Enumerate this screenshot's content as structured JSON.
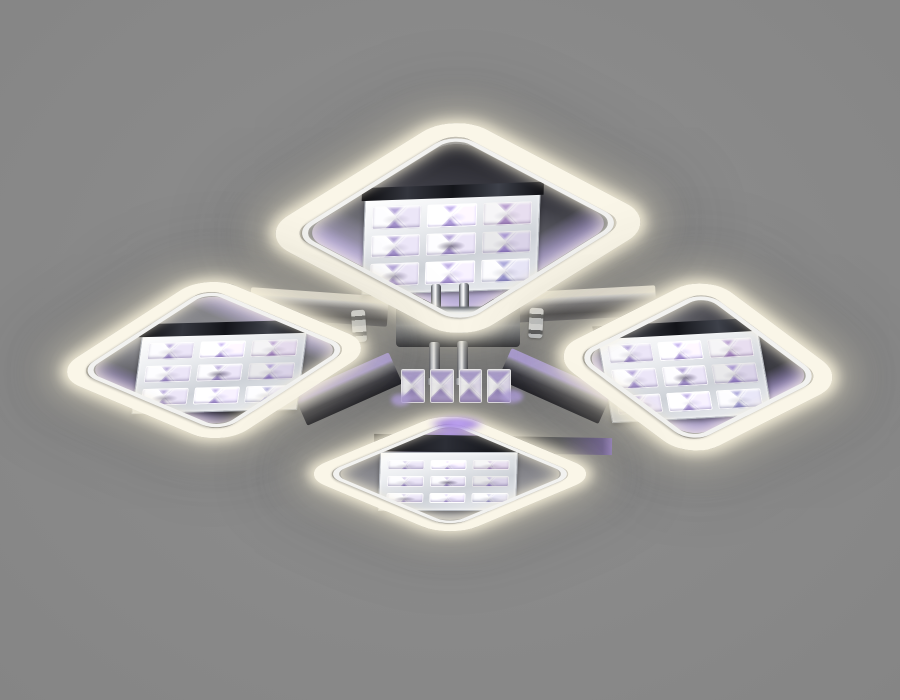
{
  "scene": {
    "type": "product-photo",
    "subject": "LED ceiling chandelier with four square halo rings and crystal panels",
    "description": "Chrome flush-mount ceiling light viewed from below: four rounded-square acrylic rings glow warm white, each framing a polished chrome plate holding a 3x3 grid of faceted crystals; a central chrome hub with rods and a small crystal cluster shows purple RGB accent lighting; plain gray studio background; no visible text.",
    "ring_count": 4,
    "plate": {
      "count": 4,
      "crystal_rows": 3,
      "crystal_cols": 3,
      "crystal_count": 9
    },
    "center_cluster": {
      "crystal_count": 4
    },
    "colors": {
      "background": "#8a8a8a",
      "band": "#faf6e8",
      "glow": "#f3ead0",
      "rim": "#f2f2f0",
      "chrome_light": "#eef0f3",
      "chrome_dark": "#26262c",
      "panel_dark": "#2e2e35",
      "panel_mid": "#90909a",
      "purple": "#b9a6e8",
      "purple_bright": "#9f7fe0"
    }
  }
}
